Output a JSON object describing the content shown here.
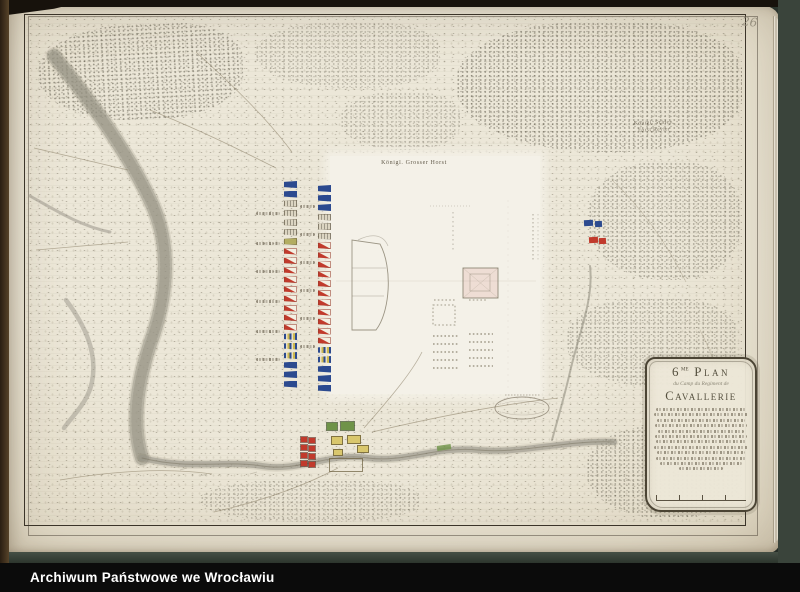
{
  "page": {
    "number": "26"
  },
  "archive_bar": {
    "label": "Archiwum Państwowe we Wrocławiu"
  },
  "labels": {
    "forest_top_center": "Königl. Grosser Horst",
    "forest_top_right_1": "Königl. Schles.",
    "forest_top_right_2": "Forst Revier"
  },
  "cartouche": {
    "number": "6",
    "number_suffix": "me",
    "title": "Plan",
    "subtitle": "du Camp du Regiment de",
    "regiment": "Cavallerie"
  },
  "troop_columns": {
    "left": [
      {
        "style": "blue",
        "count": 2
      },
      {
        "style": "gray",
        "count": 4
      },
      {
        "style": "olive",
        "count": 1
      },
      {
        "style": "red",
        "count": 9
      },
      {
        "style": "stripe",
        "count": 3
      },
      {
        "style": "blue",
        "count": 3
      }
    ],
    "right": [
      {
        "style": "blue",
        "count": 3
      },
      {
        "style": "gray",
        "count": 3
      },
      {
        "style": "red",
        "count": 11
      },
      {
        "style": "stripe",
        "count": 2
      },
      {
        "style": "blue",
        "count": 3
      }
    ]
  },
  "colors": {
    "paper": "#e8e2d1",
    "panel": "#f4f1e8",
    "table": "#313b33",
    "ink": "#46402f",
    "troop_blue": "#2c4a8f",
    "troop_red": "#c13a2c",
    "yellow": "#d9c76d",
    "green": "#6f9348",
    "river": "#9b988a"
  }
}
